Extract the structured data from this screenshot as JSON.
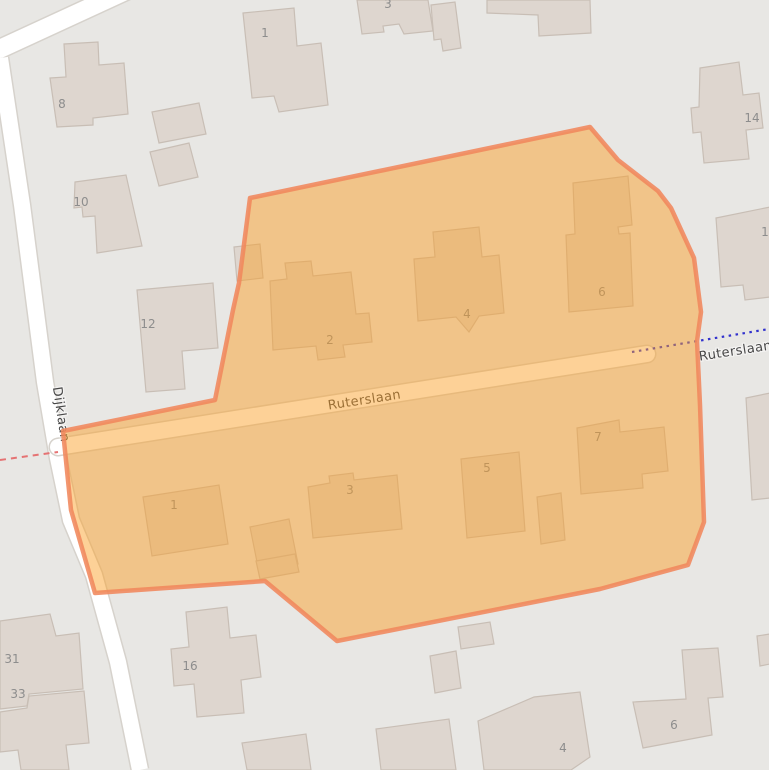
{
  "colors": {
    "background": "#e8e7e4",
    "building_fill": "#ded6cf",
    "building_stroke": "#c8beb5",
    "road_fill": "#ffffff",
    "road_casing": "#d6d2cc",
    "highlight_fill": "#fa9e21",
    "highlight_stroke": "#f0885c",
    "boundary_red": "#e57373",
    "boundary_blue": "#3232cd",
    "label_color": "#474747",
    "house_number_color": "#8d8d8d"
  },
  "map": {
    "streets": {
      "main": "Ruterslaan",
      "main_continuation": "Ruterslaan",
      "side": "Dijklaan"
    },
    "house_numbers": [
      {
        "label": "8",
        "x": 62,
        "y": 108
      },
      {
        "label": "10",
        "x": 81,
        "y": 206
      },
      {
        "label": "12",
        "x": 148,
        "y": 328
      },
      {
        "label": "1",
        "x": 265,
        "y": 37
      },
      {
        "label": "3",
        "x": 388,
        "y": 8
      },
      {
        "label": "14",
        "x": 752,
        "y": 122
      },
      {
        "label": "1",
        "x": 765,
        "y": 236
      },
      {
        "label": "16",
        "x": 190,
        "y": 670
      },
      {
        "label": "31",
        "x": 12,
        "y": 663
      },
      {
        "label": "33",
        "x": 18,
        "y": 698
      },
      {
        "label": "4",
        "x": 563,
        "y": 752
      },
      {
        "label": "6",
        "x": 674,
        "y": 729
      },
      {
        "label": "2",
        "x": 330,
        "y": 344
      },
      {
        "label": "4",
        "x": 467,
        "y": 318
      },
      {
        "label": "6",
        "x": 602,
        "y": 296
      },
      {
        "label": "1",
        "x": 174,
        "y": 509
      },
      {
        "label": "3",
        "x": 350,
        "y": 494
      },
      {
        "label": "5",
        "x": 487,
        "y": 472
      },
      {
        "label": "7",
        "x": 598,
        "y": 441
      }
    ]
  }
}
